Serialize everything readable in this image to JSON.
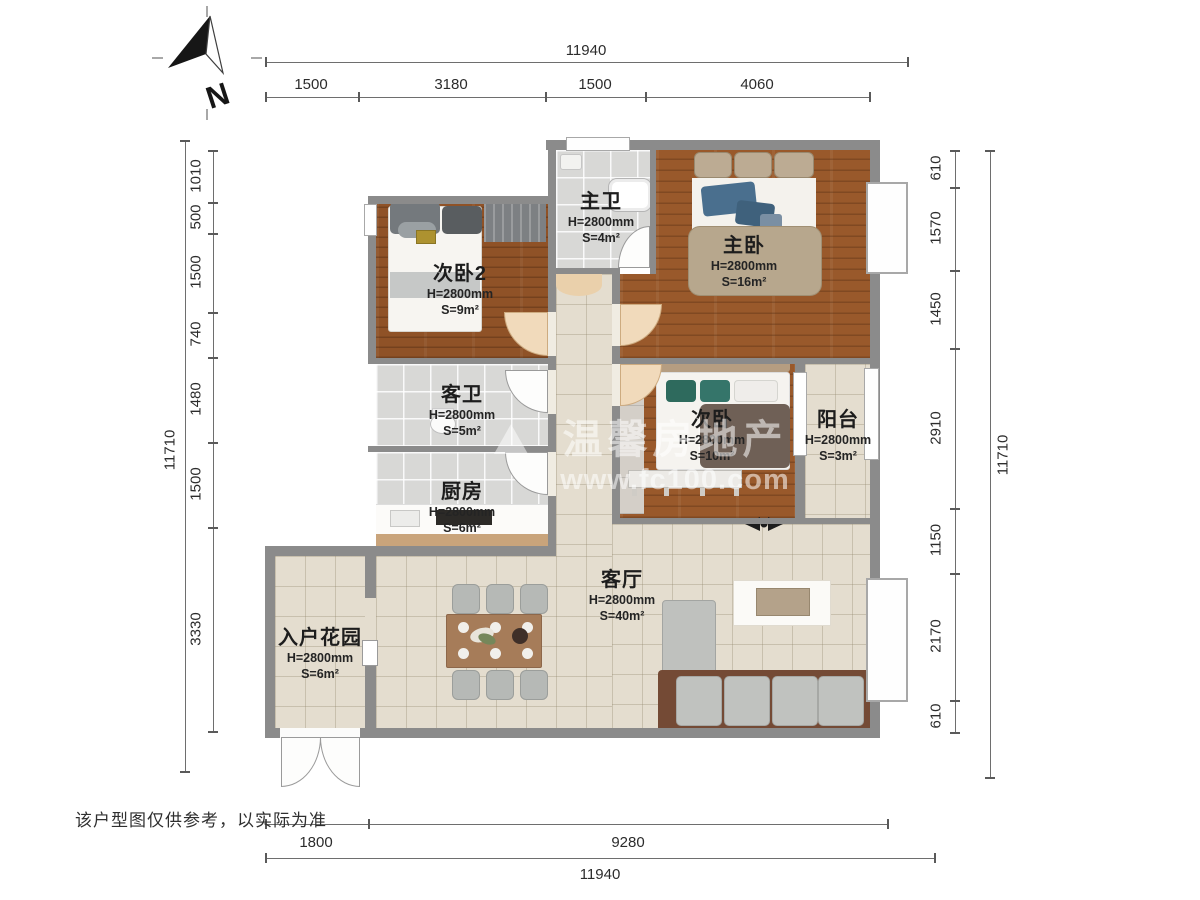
{
  "disclaimer": "该户型图仅供参考，以实际为准",
  "compass": {
    "label": "N"
  },
  "watermark": {
    "line1": "温馨房地产",
    "line2": "www.fc100.com"
  },
  "dimensions": {
    "top": {
      "total": "11940",
      "segments": [
        "1500",
        "3180",
        "1500",
        "4060"
      ]
    },
    "left": {
      "total": "11710",
      "segments": [
        "1010",
        "500",
        "1500",
        "740",
        "1480",
        "1500",
        "3330"
      ]
    },
    "right": {
      "total": "11710",
      "segments": [
        "610",
        "1570",
        "1450",
        "2910",
        "1150",
        "2170",
        "610"
      ]
    },
    "bottom": {
      "total": "11940",
      "segments": [
        "1800",
        "9280"
      ]
    }
  },
  "rooms": [
    {
      "name": "次卧2",
      "height": "H=2800mm",
      "area": "S=9m²"
    },
    {
      "name": "主卫",
      "height": "H=2800mm",
      "area": "S=4m²"
    },
    {
      "name": "主卧",
      "height": "H=2800mm",
      "area": "S=16m²"
    },
    {
      "name": "客卫",
      "height": "H=2800mm",
      "area": "S=5m²"
    },
    {
      "name": "厨房",
      "height": "H=2800mm",
      "area": "S=6m²"
    },
    {
      "name": "次卧",
      "height": "H=2800mm",
      "area": "S=10m²"
    },
    {
      "name": "阳台",
      "height": "H=2800mm",
      "area": "S=3m²"
    },
    {
      "name": "客厅",
      "height": "H=2800mm",
      "area": "S=40m²"
    },
    {
      "name": "入户花园",
      "height": "H=2800mm",
      "area": "S=6m²"
    }
  ],
  "colors": {
    "wall": "#8b8b8b",
    "wood": "#99592b",
    "tile": "#d8d8d6",
    "beige": "#e4ddcf",
    "door_arc": "#f1dabb"
  }
}
